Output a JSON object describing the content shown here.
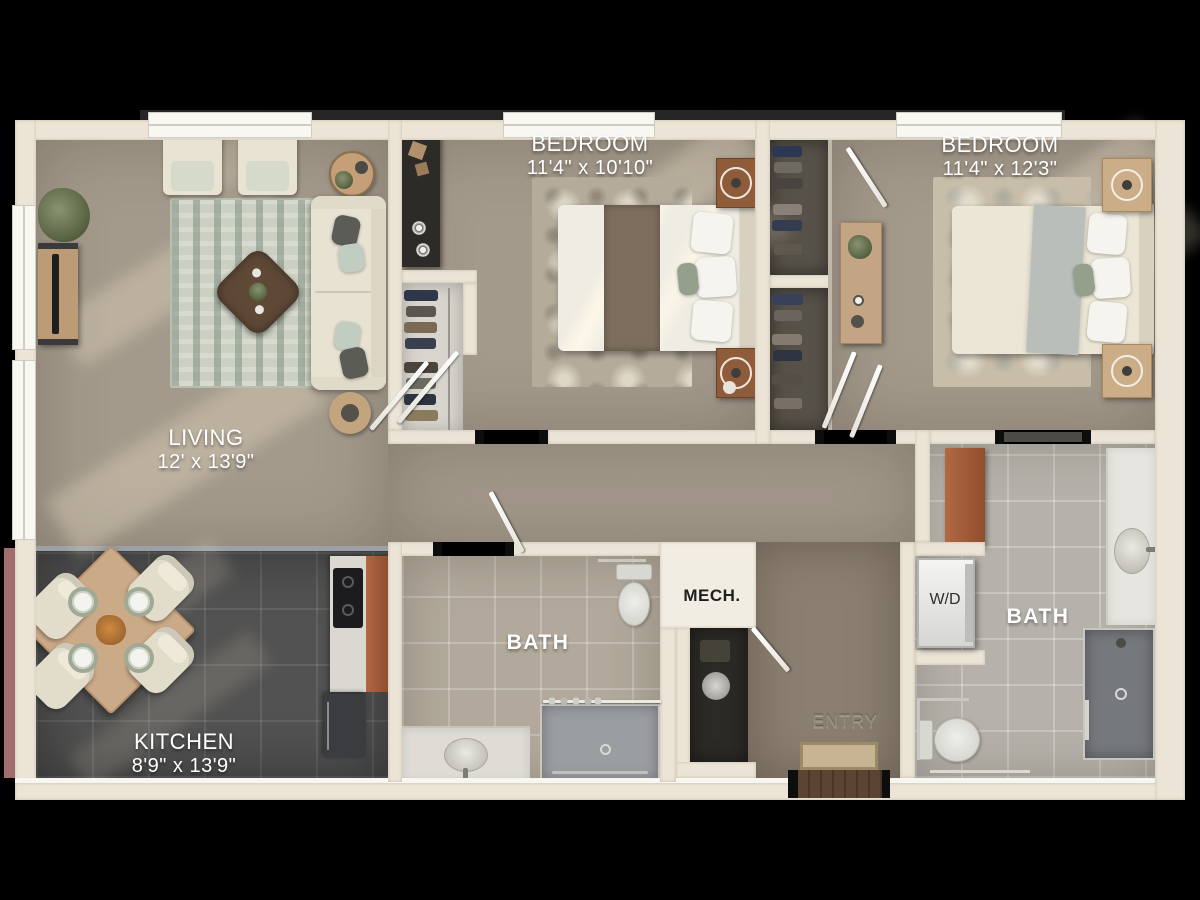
{
  "rooms": {
    "living": {
      "label": "LIVING",
      "dims": "12' x 13'9\""
    },
    "kitchen": {
      "label": "KITCHEN",
      "dims": "8'9\" x 13'9\""
    },
    "bedroom1": {
      "label": "BEDROOM",
      "dims": "11'4\" x 10'10\""
    },
    "bedroom2": {
      "label": "BEDROOM",
      "dims": "11'4\" x 12'3\""
    },
    "bath1": {
      "label": "BATH"
    },
    "bath2": {
      "label": "BATH"
    },
    "mech": {
      "label": "MECH."
    },
    "laundry": {
      "label": "W/D"
    },
    "entry": {
      "label": "ENTRY"
    }
  },
  "colors": {
    "background": "#000000",
    "wall_cream": "#ece5d7",
    "carpet": "#a49a8c",
    "entry_carpet": "#8b7f71",
    "kitchen_tile": "#525252",
    "bath1_tile": "#b2a99c",
    "bath2_tile": "#b6b2ab",
    "cabinet_accent": "#b26843",
    "exterior_accent": "#a26d6f",
    "label_text": "#ffffff"
  }
}
